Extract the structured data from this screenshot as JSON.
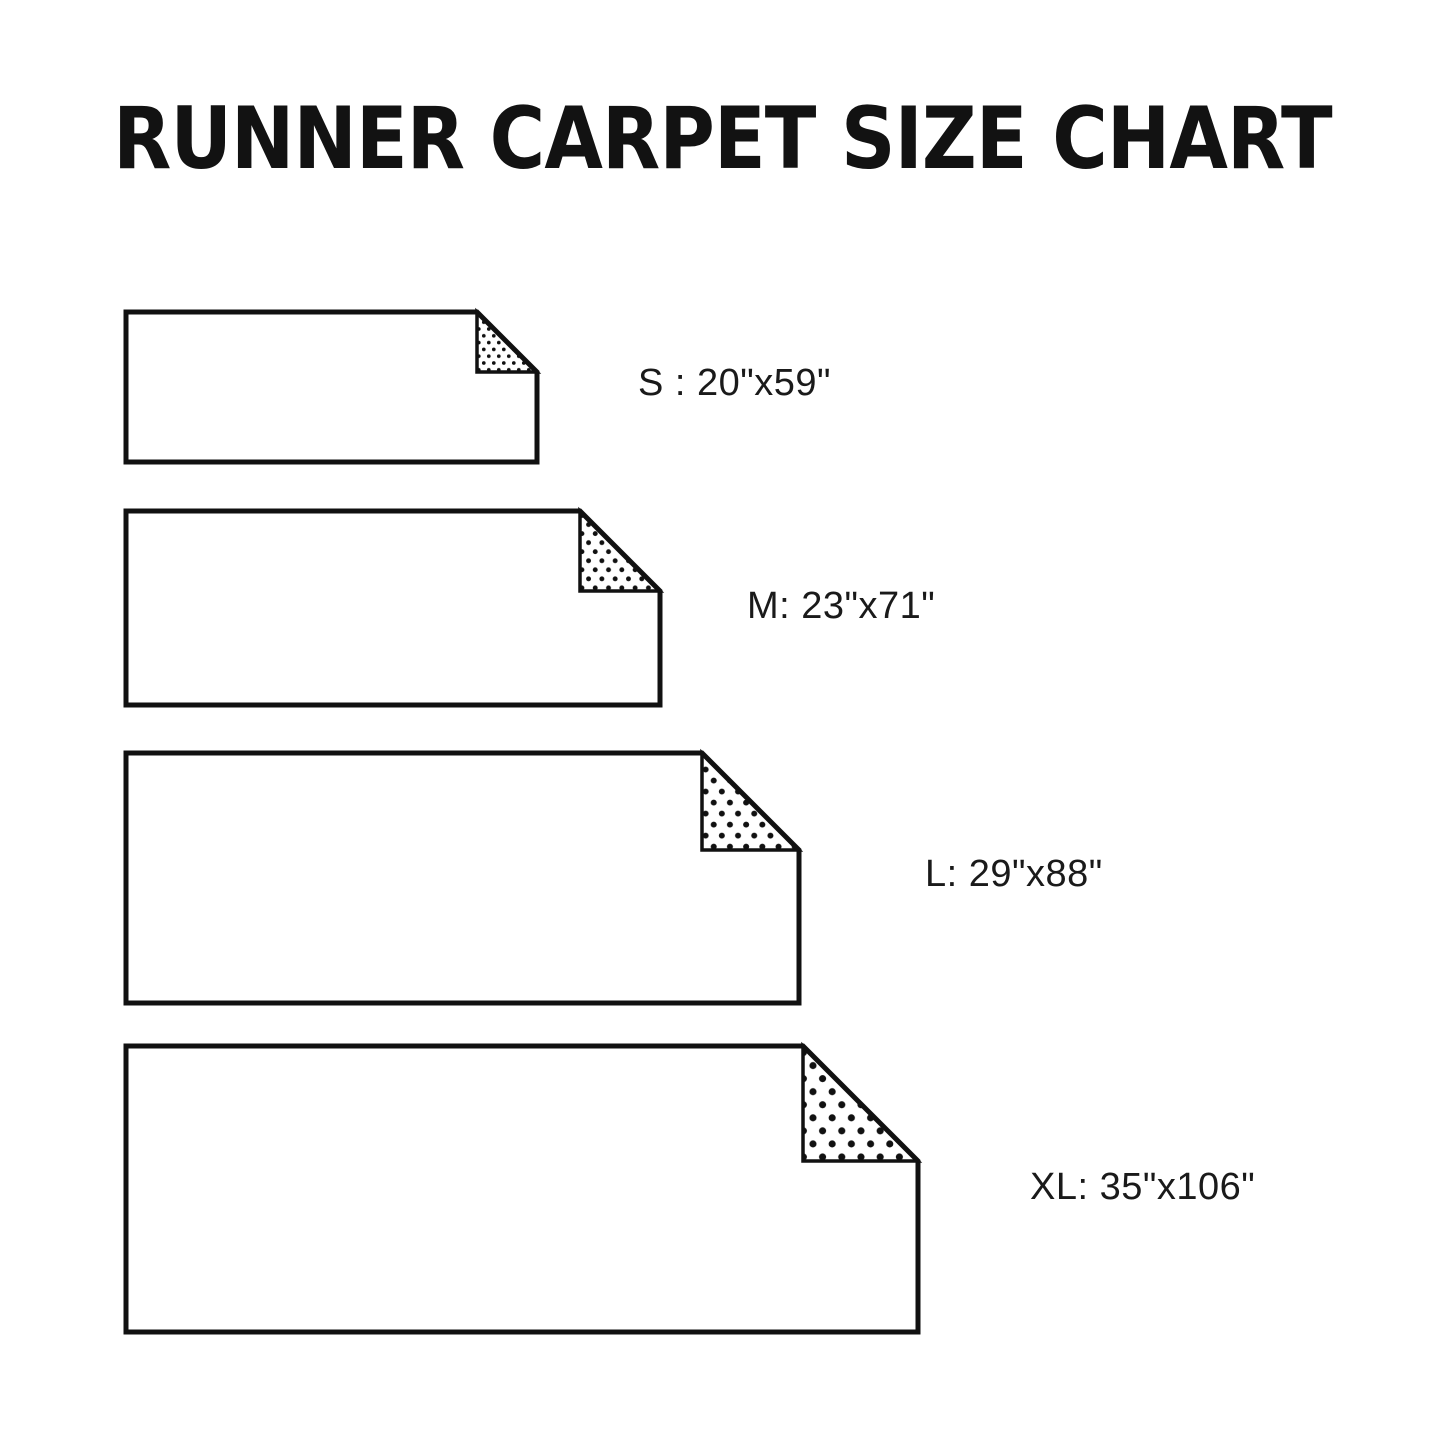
{
  "title": "RUNNER CARPET SIZE CHART",
  "sizes": [
    {
      "code": "S",
      "dimensions": "20\"x59\"",
      "label": "S : 20\"x59\""
    },
    {
      "code": "M",
      "dimensions": "23\"x71\"",
      "label": "M: 23\"x71\""
    },
    {
      "code": "L",
      "dimensions": "29\"x88\"",
      "label": "L: 29\"x88\""
    },
    {
      "code": "XL",
      "dimensions": "35\"x106\"",
      "label": "XL: 35\"x106\""
    }
  ],
  "colors": {
    "background": "#ffffff",
    "line": "#111111",
    "dot": "#111111",
    "text": "#1a1a1a"
  }
}
